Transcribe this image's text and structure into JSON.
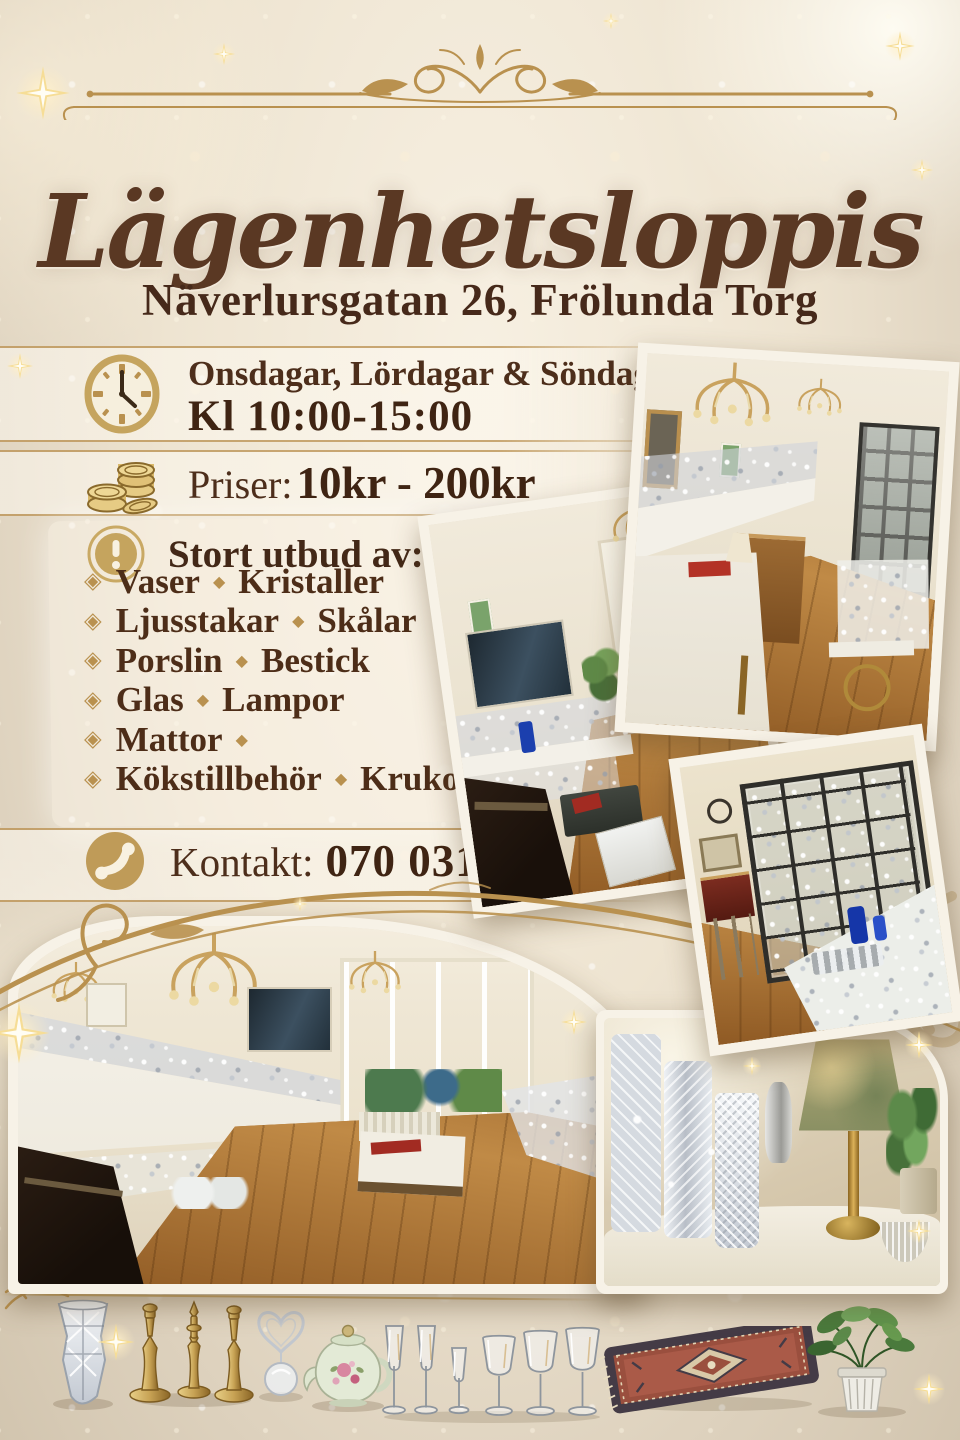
{
  "poster": {
    "title": "Lägenhetsloppis",
    "address": "Näverlursgatan 26, Frölunda Torg",
    "schedule": {
      "days": "Onsdagar, Lördagar & Söndagar",
      "hours": "Kl 10:00-15:00"
    },
    "prices": {
      "label": "Priser:",
      "range": "10kr - 200kr"
    },
    "assortment": {
      "heading": "Stort utbud av:",
      "bullet": "◈",
      "separator": "◆",
      "items": [
        {
          "a": "Vaser",
          "b": "Kristaller"
        },
        {
          "a": "Ljusstakar",
          "b": "Skålar"
        },
        {
          "a": "Porslin",
          "b": "Bestick"
        },
        {
          "a": "Glas",
          "b": "Lampor"
        },
        {
          "a": "Mattor",
          "b": ""
        },
        {
          "a": "Kökstillbehör",
          "b": "Krukor"
        }
      ]
    },
    "contact": {
      "label": "Kontakt:",
      "phone": "070 031 83 46"
    },
    "icons": {
      "clock": "clock-icon",
      "coins": "coins-icon",
      "alert": "exclamation-icon",
      "phone": "phone-icon",
      "bullet": "diamond-bullet-icon",
      "separator": "diamond-separator-icon",
      "sparkle": "sparkle-star-icon",
      "flourish": "gold-flourish-ornament"
    },
    "colors": {
      "background_cream": "#e9dfcc",
      "gold_accent": "#b9914f",
      "text_brown": "#4a2c18",
      "title_brown": "#5a3823",
      "photo_border": "#f7f2e7"
    },
    "photos": [
      "apartment-room-long-tables",
      "apartment-room-tv-corner",
      "display-cabinet-and-table",
      "apartment-panorama",
      "crystal-vases-and-table-lamp"
    ],
    "bottom_row_products": [
      "crystal-vase",
      "brass-candlesticks",
      "silver-heart-ornament-and-glass-ball",
      "porcelain-teapot",
      "champagne-and-wine-glasses",
      "oriental-rug",
      "potted-plant"
    ]
  }
}
